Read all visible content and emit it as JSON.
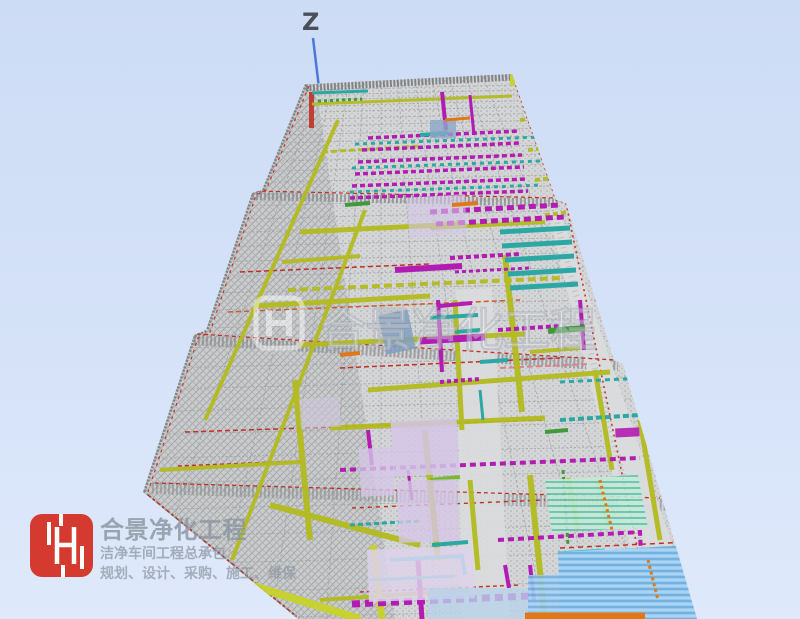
{
  "viewport": {
    "axis_label": "Z"
  },
  "watermark": {
    "text": "合景净化工程"
  },
  "branding": {
    "logo_monogram": "H",
    "company_name": "合景净化工程",
    "tagline": "洁净车间工程总承包",
    "services": "规划、设计、采购、施工、维保"
  },
  "colors": {
    "background_top": "#cddcf5",
    "background_bottom": "#dfe9fb",
    "mesh_base": "#d4d5d6",
    "mesh_dark": "#8f9396",
    "beam_yellow": "#b3bb1e",
    "beam_yellow_bright": "#c8d22b",
    "line_red": "#c03026",
    "duct_magenta": "#b31cb3",
    "duct_purple": "#8c2a9e",
    "pipe_teal": "#2ba8a4",
    "pipe_cyan": "#2ec8dc",
    "panel_lavender": "#d4c6e6",
    "panel_blue": "#96c8f0",
    "panel_mint": "#c2ead4",
    "accent_green": "#3f9a3a",
    "accent_orange": "#e07818",
    "axis_blue": "#4a78d8",
    "axis_text": "#4a5058",
    "logo_red": "#d43a2f",
    "company_text": "#8c95a0"
  }
}
